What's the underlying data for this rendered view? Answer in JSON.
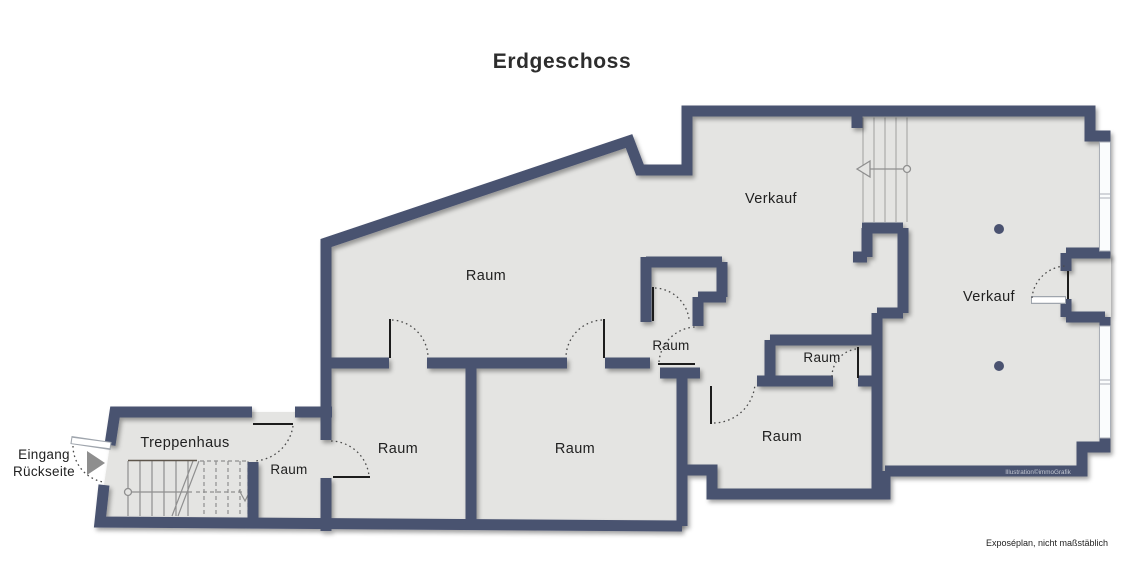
{
  "title": "Erdgeschoss",
  "floor_plan": {
    "rooms": {
      "verkauf_top": "Verkauf",
      "verkauf_right": "Verkauf",
      "raum_large": "Raum",
      "raum_center": "Raum",
      "raum_center_right": "Raum",
      "raum_lower_right": "Raum",
      "raum_lower_left": "Raum",
      "raum_lower_middle": "Raum",
      "raum_hallway": "Raum",
      "treppenhaus": "Treppenhaus"
    },
    "entrance": {
      "line1": "Eingang",
      "line2": "Rückseite"
    },
    "watermark": "Illustration©immoGrafik",
    "disclaimer": "Exposéplan, nicht maßstäblich",
    "colors": {
      "wall": "#4a5270",
      "floor": "#e4e4e2",
      "window": "#fafcfd",
      "arrow": "#8e8e8e"
    }
  }
}
